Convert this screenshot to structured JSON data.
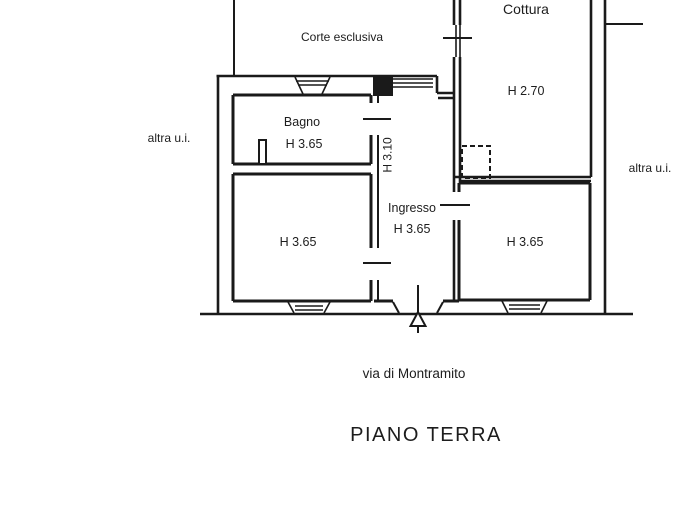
{
  "page": {
    "background": "#ffffff",
    "line_color": "#1a1a1a",
    "text_color": "#1d1d1d"
  },
  "plan": {
    "floor_title": "PIANO TERRA",
    "street_label": "via di Montramito",
    "outdoor_labels": {
      "corte": "Corte esclusiva",
      "altra_ui_left": "altra u.i.",
      "altra_ui_right": "altra u.i."
    },
    "corridor_height_label": "H 3.10",
    "rooms": [
      {
        "id": "cottura",
        "name": "Cottura",
        "height": "H 2.70"
      },
      {
        "id": "bagno",
        "name": "Bagno",
        "height": "H 3.65"
      },
      {
        "id": "ingresso",
        "name": "Ingresso",
        "height": "H 3.65"
      },
      {
        "id": "camera-left",
        "name": "",
        "height": "H 3.65"
      },
      {
        "id": "camera-right",
        "name": "",
        "height": "H 3.65"
      }
    ]
  }
}
